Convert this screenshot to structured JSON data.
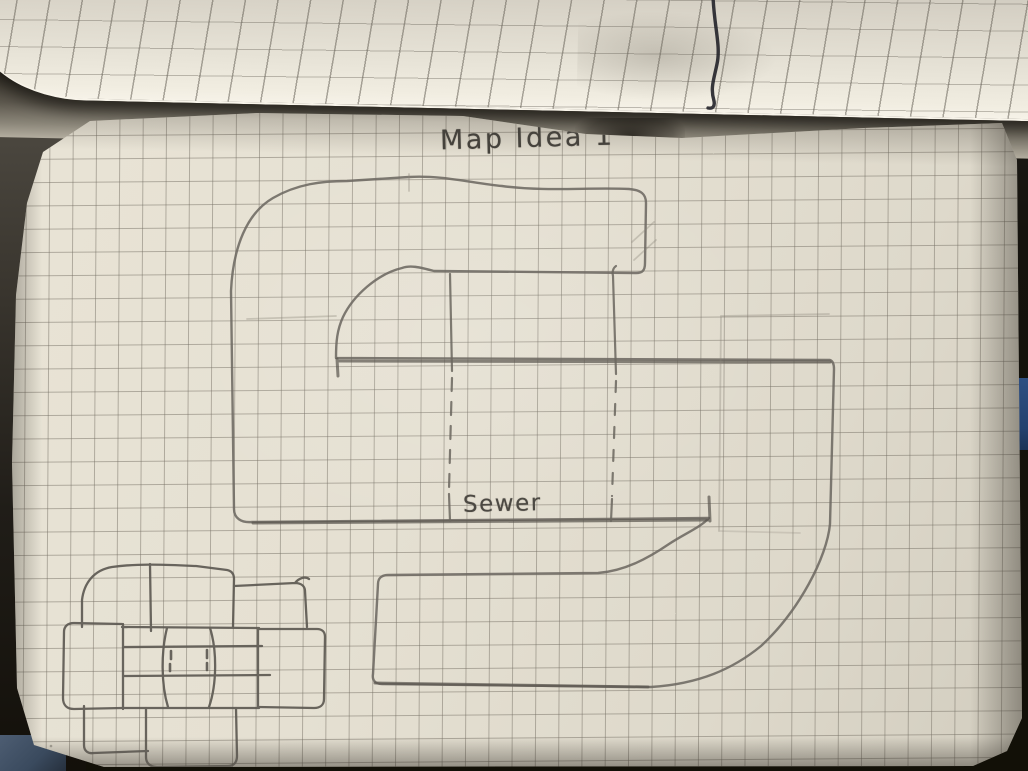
{
  "scene": {
    "description": "Photograph of an open graph-paper notebook; the upper page is curled back and the flat page shows a pencil sketch of a level map",
    "objects": [
      "curled upper page with pen mark",
      "graph paper page",
      "large S-shaped map outline",
      "dashed underground tunnel lines",
      "cluster of small connected rooms"
    ],
    "colors": {
      "paper": "#e5e0d2",
      "upper_paper": "#ddd8cc",
      "grid_line": "#767065",
      "pencil": "#6b675f",
      "pen_mark": "#26262c",
      "background": "#15130e",
      "blue_accent_right": "#2c4c7e",
      "blue_accent_bottom_left": "#46566b"
    }
  },
  "annotations": {
    "title": "Map Idea 1",
    "sewer_label": "Sewer"
  },
  "sketch": {
    "main_shape": "large S-shaped corridor outline",
    "tunnel": "two dashed vertical lines crossing the middle bar, labeled Sewer",
    "secondary_shape": "plus-shaped cluster of six rooms around a central hub, bottom-left"
  }
}
